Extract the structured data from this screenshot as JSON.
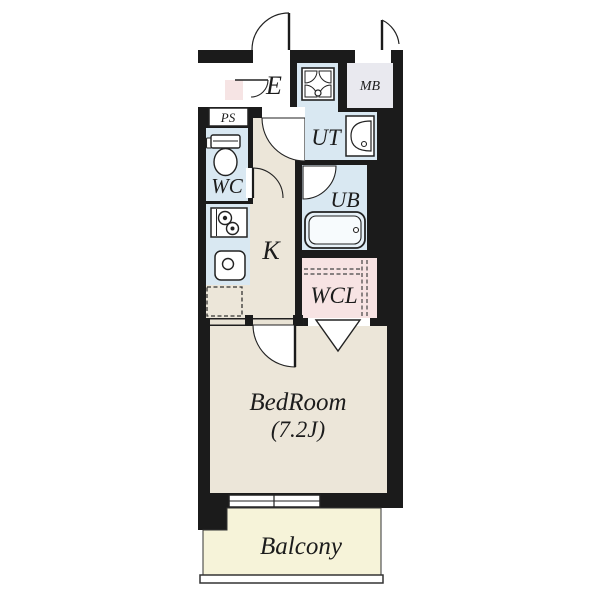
{
  "floorplan": {
    "rooms": {
      "entrance": {
        "label": "E"
      },
      "meter_box": {
        "label": "MB"
      },
      "pipe_space": {
        "label": "PS"
      },
      "toilet": {
        "label": "WC"
      },
      "utility": {
        "label": "UT"
      },
      "unit_bath": {
        "label": "UB"
      },
      "kitchen": {
        "label": "K"
      },
      "walk_in_closet": {
        "label": "WCL"
      },
      "bedroom": {
        "label": "BedRoom",
        "size_label": "(7.2J)"
      },
      "balcony": {
        "label": "Balcony"
      }
    },
    "colors": {
      "wall": "#1b1b1b",
      "floor_beige": "#ece6d9",
      "wet_area_blue": "#d9e8f2",
      "closet_pink": "#f7e3e3",
      "balcony_yellow": "#f6f3d9",
      "meter_box_gray": "#e9e9ef",
      "fixture_white": "#ffffff",
      "line_dark": "#222222"
    }
  }
}
